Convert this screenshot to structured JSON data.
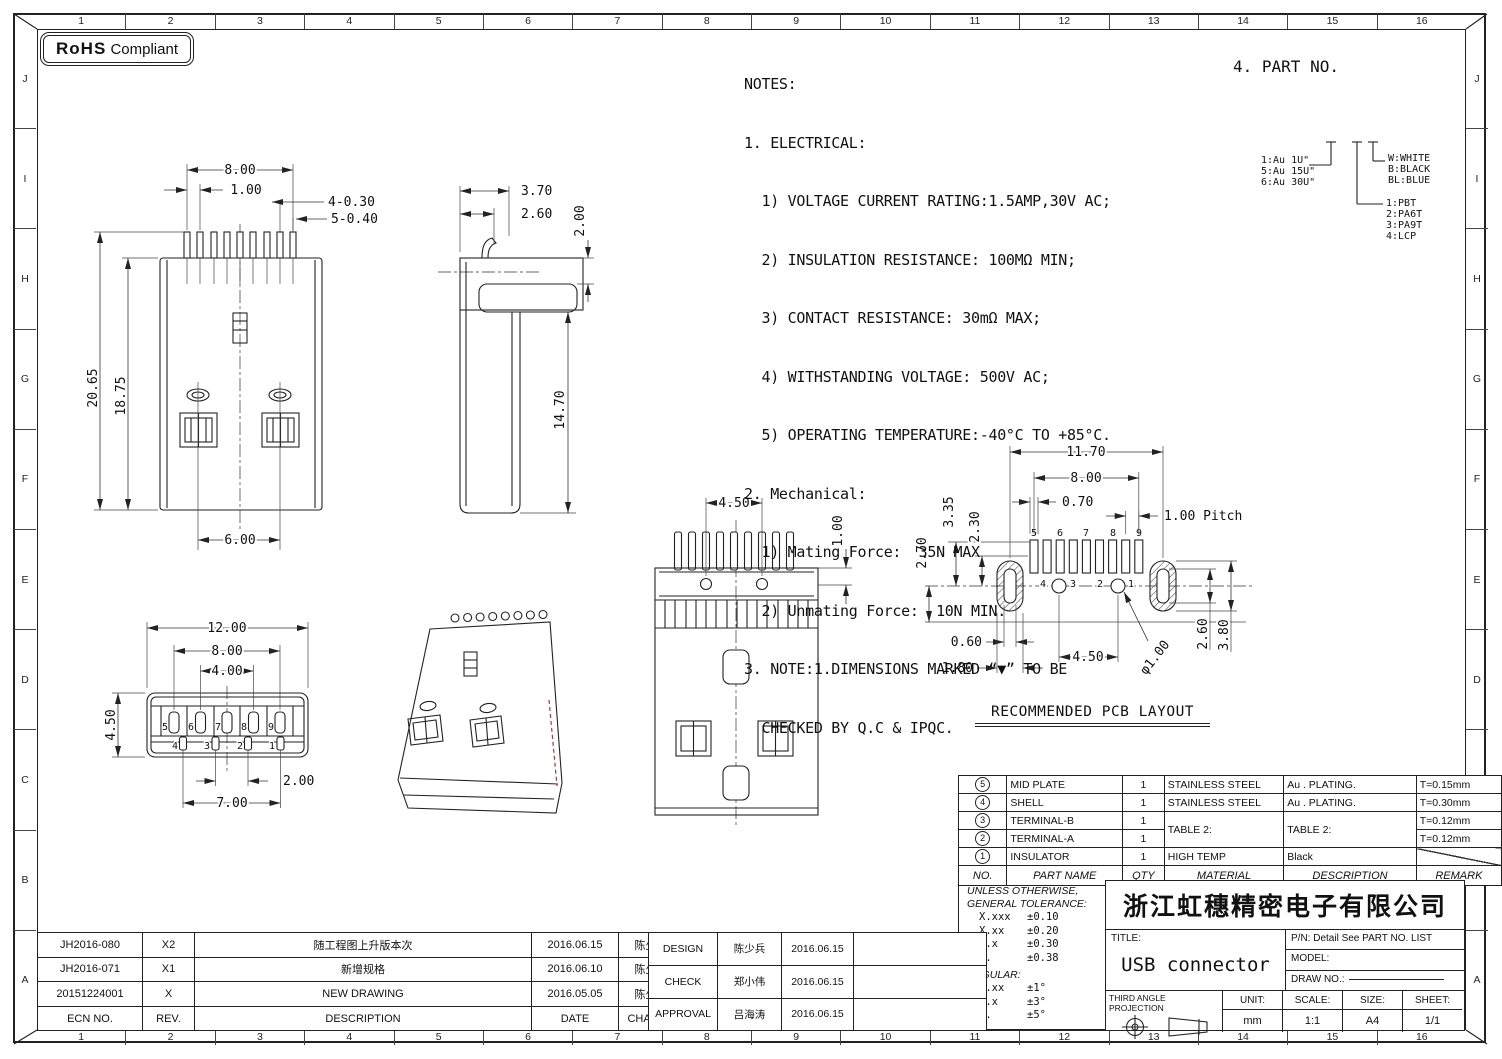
{
  "frame": {
    "cols": [
      "1",
      "2",
      "3",
      "4",
      "5",
      "6",
      "7",
      "8",
      "9",
      "10",
      "11",
      "12",
      "13",
      "14",
      "15",
      "16"
    ],
    "rows": [
      "J",
      "I",
      "H",
      "G",
      "F",
      "E",
      "D",
      "C",
      "B",
      "A"
    ]
  },
  "rohs": {
    "strong": "RoHS",
    "rest": "Compliant"
  },
  "notes": {
    "lines": [
      "NOTES:",
      "1. ELECTRICAL:",
      "  1) VOLTAGE CURRENT RATING:1.5AMP,30V AC;",
      "  2) INSULATION RESISTANCE: 100MΩ MIN;",
      "  3) CONTACT RESISTANCE: 30mΩ MAX;",
      "  4) WITHSTANDING VOLTAGE: 500V AC;",
      "  5) OPERATING TEMPERATURE:-40°C TO +85°C.",
      "2. Mechanical:",
      "  1) Mating Force:  35N MAX",
      "  2) Unmating Force:  10N MIN.",
      "3. NOTE:1.DIMENSIONS MARKED “▼” TO BE",
      "  CHECKED BY Q.C & IPQC."
    ]
  },
  "part_no": {
    "title": "4. PART NO.",
    "plating": "1:Au 1U\"\n5:Au 15U\"\n6:Au 30U\"",
    "colors": "W:WHITE\nB:BLACK\nBL:BLUE",
    "materials": "1:PBT\n2:PA6T\n3:PA9T\n4:LCP"
  },
  "views": {
    "front": {
      "w800": "8.00",
      "w100": "1.00",
      "p430": "4-0.30",
      "p540": "5-0.40",
      "h2065": "20.65",
      "h1875": "18.75",
      "w600": "6.00"
    },
    "side": {
      "w370": "3.70",
      "w260": "2.60",
      "h200": "2.00",
      "h1470": "14.70"
    },
    "bottom": {
      "w1200": "12.00",
      "w800": "8.00",
      "w400": "4.00",
      "h450": "4.50",
      "w200": "2.00",
      "w700": "7.00",
      "pins_top": [
        "5",
        "6",
        "7",
        "8",
        "9"
      ],
      "pins_bot": [
        "4",
        "3",
        "2",
        "1"
      ]
    },
    "back": {
      "w450": "4.50",
      "h100": "1.00"
    },
    "pcb": {
      "title": "RECOMMENDED PCB LAYOUT",
      "w1170": "11.70",
      "w800": "8.00",
      "w070": "0.70",
      "pitch": "1.00 Pitch",
      "h335": "3.35",
      "h230": "2.30",
      "h270": "2.70",
      "w060": "0.60",
      "w180": "1.80",
      "w450": "4.50",
      "dia": "φ1.00",
      "h260": "2.60",
      "h380": "3.80",
      "pins_top": [
        "5",
        "6",
        "7",
        "8",
        "9"
      ],
      "pins_bot": [
        "4",
        "3",
        "2",
        "1"
      ]
    }
  },
  "bom": {
    "headers": {
      "no": "NO.",
      "part": "PART NAME",
      "qty": "QTY",
      "material": "MATERIAL",
      "description": "DESCRIPTION",
      "remark": "REMARK"
    },
    "rows": [
      {
        "no": "5",
        "part": "MID PLATE",
        "qty": "1",
        "material": "STAINLESS STEEL",
        "description": "Au . PLATING.",
        "remark": "T=0.15mm"
      },
      {
        "no": "4",
        "part": "SHELL",
        "qty": "1",
        "material": "STAINLESS STEEL",
        "description": "Au . PLATING.",
        "remark": "T=0.30mm"
      },
      {
        "no": "3",
        "part": "TERMINAL-B",
        "qty": "1",
        "material": "TABLE 2:",
        "description": "TABLE 2:",
        "remark": "T=0.12mm"
      },
      {
        "no": "2",
        "part": "TERMINAL-A",
        "qty": "1",
        "remark": "T=0.12mm"
      },
      {
        "no": "1",
        "part": "INSULATOR",
        "qty": "1",
        "material": "HIGH TEMP",
        "description": "Black",
        "remark": ""
      }
    ]
  },
  "tolerance": {
    "head1": "UNLESS OTHERWISE,",
    "head2": "GENERAL TOLERANCE:",
    "rows": [
      {
        "k": "X.xxx",
        "v": "±0.10"
      },
      {
        "k": "X.xx",
        "v": "±0.20"
      },
      {
        "k": "X.x",
        "v": "±0.30"
      },
      {
        "k": "X.",
        "v": "±0.38"
      }
    ],
    "angular": "ANGULAR:",
    "arows": [
      {
        "k": "X.xx",
        "v": "±1°"
      },
      {
        "k": "X.x",
        "v": "±3°"
      },
      {
        "k": "X.",
        "v": "±5°"
      }
    ]
  },
  "title_block": {
    "company": "浙江虹穗精密电子有限公司",
    "title_label": "TITLE:",
    "title": "USB connector",
    "pn": "P/N: Detail See PART NO. LIST",
    "model_label": "MODEL:",
    "drawno_label": "DRAW NO.:",
    "projection": "THIRD ANGLE PROJECTION",
    "unit_label": "UNIT:",
    "unit": "mm",
    "scale_label": "SCALE:",
    "scale": "1:1",
    "size_label": "SIZE:",
    "size": "A4",
    "sheet_label": "SHEET:",
    "sheet": "1/1"
  },
  "revisions": {
    "h_ecn": "ECN NO.",
    "h_rev": "REV.",
    "h_desc": "DESCRIPTION",
    "h_date": "DATE",
    "h_change": "CHANGE",
    "rows": [
      {
        "ecn": "JH2016-080",
        "rev": "X2",
        "desc": "随工程图上升版本次",
        "date": "2016.06.15",
        "change": "陈少兵"
      },
      {
        "ecn": "JH2016-071",
        "rev": "X1",
        "desc": "新增规格",
        "date": "2016.06.10",
        "change": "陈少兵"
      },
      {
        "ecn": "20151224001",
        "rev": "X",
        "desc": "NEW DRAWING",
        "date": "2016.05.05",
        "change": "陈少兵"
      }
    ]
  },
  "signoff": {
    "rows": [
      {
        "role": "DESIGN",
        "name": "陈少兵",
        "date": "2016.06.15"
      },
      {
        "role": "CHECK",
        "name": "郑小伟",
        "date": "2016.06.15"
      },
      {
        "role": "APPROVAL",
        "name": "吕海涛",
        "date": "2016.06.15"
      }
    ]
  }
}
